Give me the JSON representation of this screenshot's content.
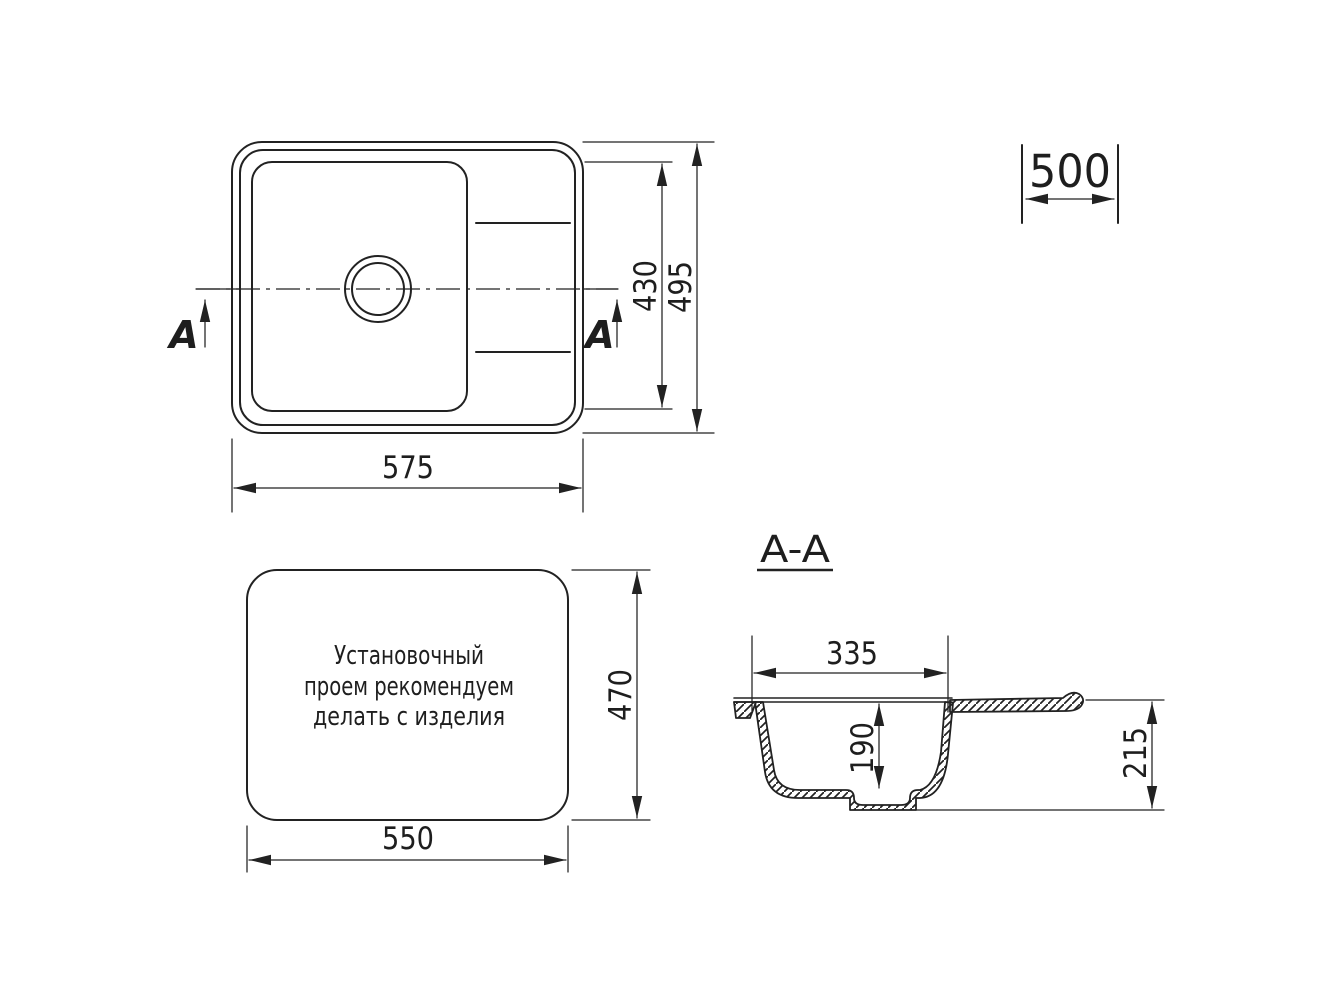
{
  "colors": {
    "line": "#222222",
    "text": "#1e1e1e",
    "background": "#ffffff"
  },
  "plan_view": {
    "section_marker_left": "A",
    "section_marker_right": "A",
    "dim_width": "575",
    "dim_bowl_height": "430",
    "dim_height": "495"
  },
  "overall_depth_dim": {
    "value": "500"
  },
  "cutout_view": {
    "note_lines": [
      "Установочный",
      "проем рекомендуем",
      "делать с изделия"
    ],
    "dim_width": "550",
    "dim_height": "470"
  },
  "section_view": {
    "title": "A-A",
    "dim_bowl_width": "335",
    "dim_bowl_depth": "190",
    "dim_height": "215"
  }
}
